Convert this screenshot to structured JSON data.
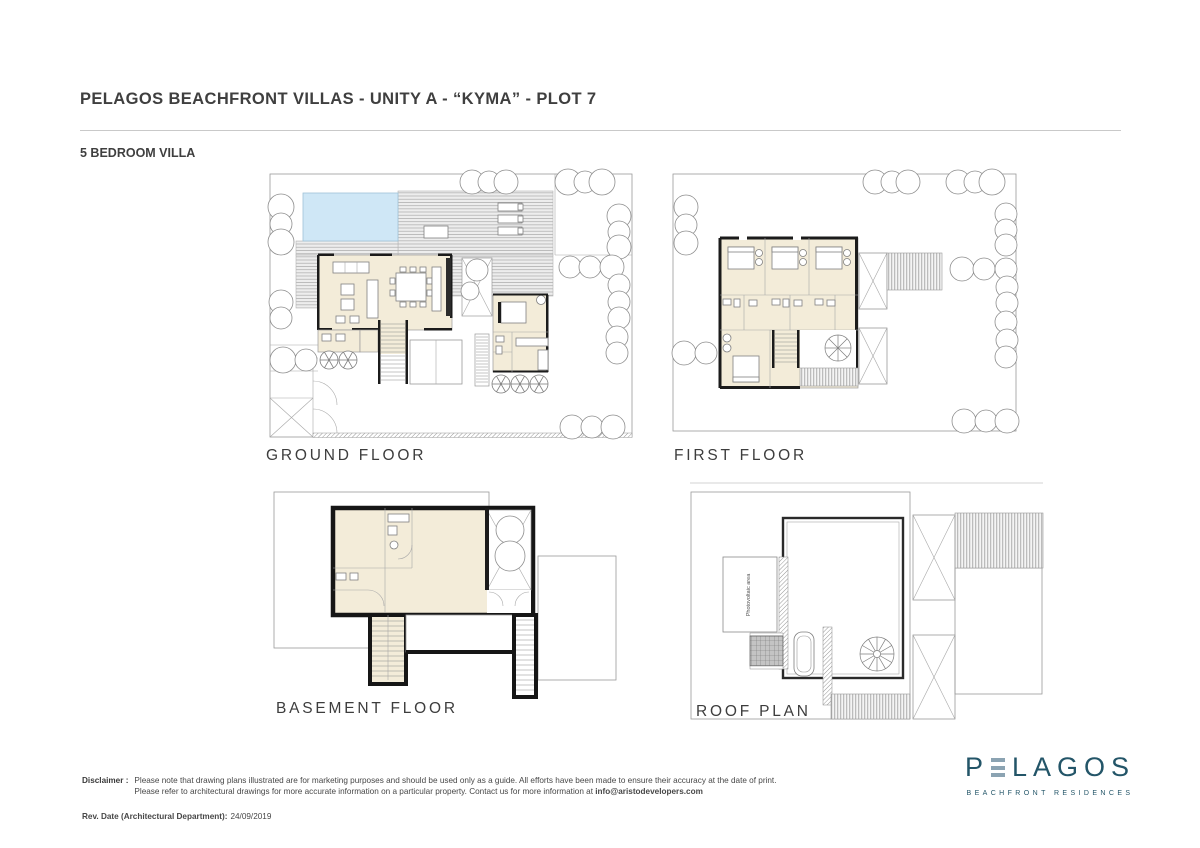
{
  "page": {
    "title": "PELAGOS BEACHFRONT VILLAS - UNITY A - “KYMA” - PLOT 7",
    "subtitle": "5 BEDROOM VILLA"
  },
  "plans": {
    "ground": {
      "label": "GROUND FLOOR"
    },
    "first": {
      "label": "FIRST FLOOR"
    },
    "basement": {
      "label": "BASEMENT FLOOR"
    },
    "roof": {
      "label": "ROOF PLAN",
      "photovoltaic_area_label": "Photovoltaic area"
    }
  },
  "footer": {
    "disclaimer_label": "Disclaimer :",
    "disclaimer_line1": "Please note that drawing plans illustrated are for marketing purposes and should be used only as a guide. All efforts have been made to ensure their accuracy at the date of print.",
    "disclaimer_line2": "Please refer to architectural drawings for more accurate information on a particular property. Contact us for more information at",
    "disclaimer_email": "info@aristodevelopers.com",
    "revision_label": "Rev. Date (Architectural Department):",
    "revision_date": "24/09/2019"
  },
  "logo": {
    "brand_prefix": "P",
    "brand_suffix": "LAGOS",
    "tagline": "BEACHFRONT RESIDENCES",
    "colors": {
      "teal": "#235568",
      "bars": "#8ba3b2"
    }
  },
  "plan_colors": {
    "room_cream": "#f3ecd9",
    "pool_blue": "#cfe7f6",
    "wall_black": "#1b1b1b",
    "deck_gray": "#ededed"
  }
}
